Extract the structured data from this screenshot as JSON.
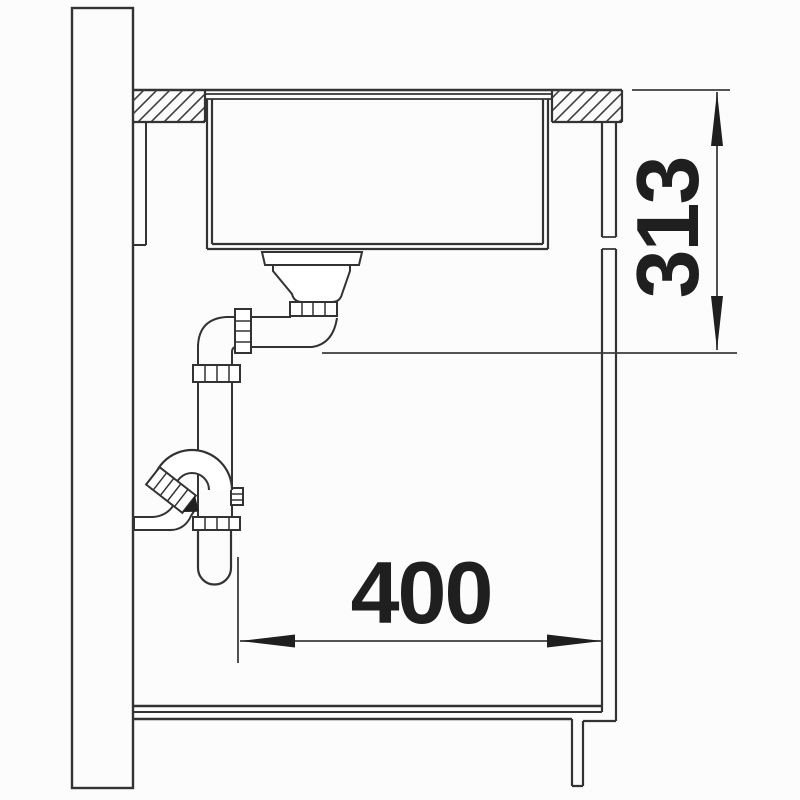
{
  "style": {
    "background": "#fcfcfc",
    "line_color": "#333333",
    "dim_line_color": "#3d3d3d",
    "text_color": "#1f1f1f"
  },
  "dimensions": {
    "vertical": {
      "label": "313"
    },
    "horizontal": {
      "label": "400"
    }
  },
  "parts": [
    "wall",
    "worktop",
    "undermount-sink-bowl",
    "basket-strainer",
    "drain-pipe",
    "siphon-trap",
    "cabinet-side-panel",
    "cabinet-bottom",
    "plinth"
  ]
}
